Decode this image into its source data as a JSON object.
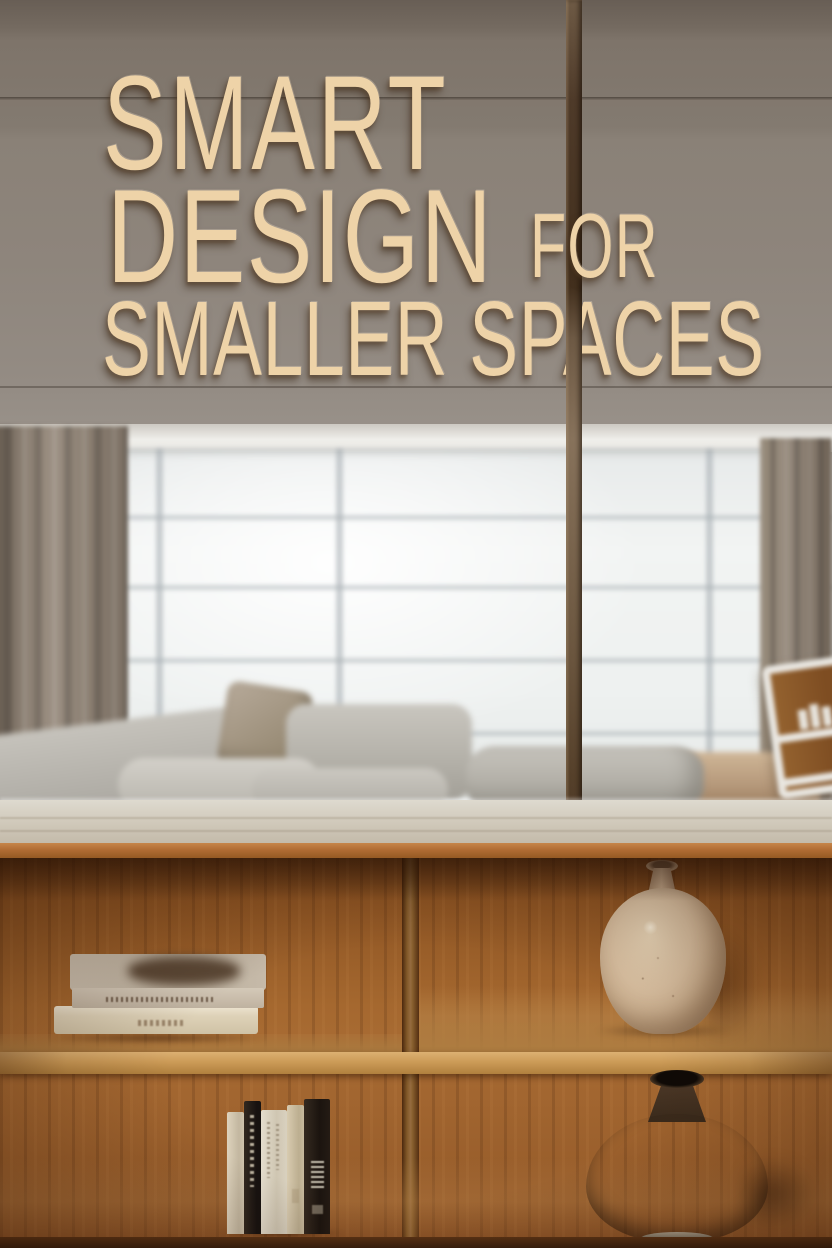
{
  "headline": {
    "line1": "SMART",
    "line2": "DESIGN",
    "line2_suffix": "FOR",
    "line3": "SMALLER SPACES"
  },
  "palette": {
    "wall_top": "#685e55",
    "wall_bottom": "#9b948c",
    "letters": "#eed3a8",
    "letter_shadow": "rgba(58,40,24,0.55)",
    "pole_dark": "#44311f",
    "pole_light": "#87725b",
    "ceiling": "#efeeea",
    "window_bright": "#f2f4f3",
    "mullion": "#a3aaaf",
    "curtain": "#8f8376",
    "sofa_light": "#d3d0c9",
    "sofa_mid": "#a7a49c",
    "pillow_taupe": "#a89a84",
    "floor_tan": "#b5987a",
    "side_unit_frame": "#e9e6e0",
    "side_unit_wood": "#8a5a2e",
    "counter_top": "#d2cbbd",
    "counter_edge": "#b06c33",
    "shelf_wood": "#9c6130",
    "shelf_board": "#cc9b57",
    "book_cream": "#ded2b8",
    "book_black": "#1b140f",
    "book_white": "#e4ddcd",
    "vase_cream": "#d9c0a1",
    "vase_dark": "#382718",
    "vase_dark_base": "#d8cab1"
  },
  "scene": {
    "objects": [
      "wall",
      "ceiling",
      "window",
      "curtain-left",
      "curtain-right",
      "support-pole",
      "sectional-sofa",
      "throw-pillow",
      "ottoman",
      "side-shelf-unit",
      "wood-countertop",
      "oak-bookshelf",
      "stacked-books",
      "standing-books",
      "cream-speckled-vase",
      "dark-bronze-vase"
    ]
  }
}
